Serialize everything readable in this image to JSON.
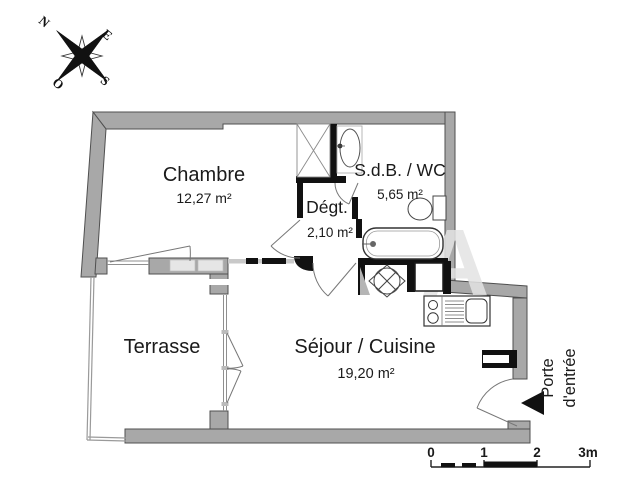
{
  "compass": {
    "north": "N",
    "east": "E",
    "south": "S",
    "west": "O"
  },
  "rooms": {
    "chambre": {
      "name": "Chambre",
      "area": "12,27 m²"
    },
    "degagement": {
      "name": "Dégt.",
      "area": "2,10 m²"
    },
    "sdb": {
      "name": "S.d.B. / WC",
      "area": "5,65 m²"
    },
    "sejour": {
      "name": "Séjour / Cuisine",
      "area": "19,20 m²"
    },
    "terrasse": {
      "name": "Terrasse",
      "area": ""
    }
  },
  "entrance": {
    "line1": "Porte",
    "line2": "d'entrée"
  },
  "scale_bar": {
    "labels": [
      "0",
      "1",
      "2",
      "3m"
    ]
  },
  "watermark": "A",
  "colors": {
    "wall_gray": "#a8a8a8",
    "wall_outline": "#4f4f4f",
    "partition_black": "#111111",
    "window_light": "#e6e6e6",
    "text": "#1a1a1a"
  }
}
